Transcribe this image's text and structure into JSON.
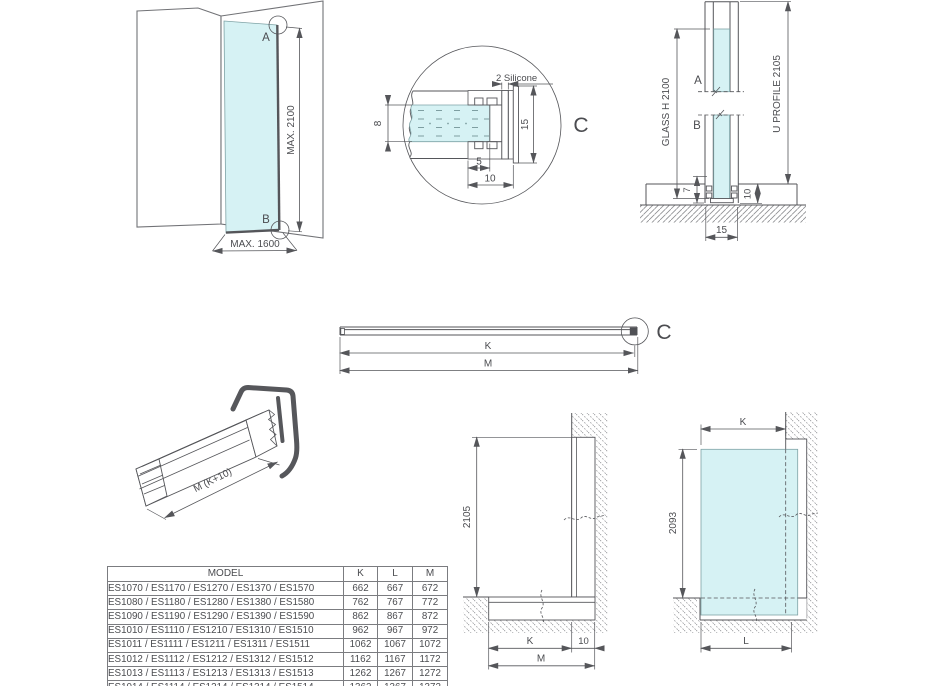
{
  "colors": {
    "line": "#55565a",
    "text": "#4b4c50",
    "glass": "#d6f2f4",
    "wall": "#717276",
    "table_border": "#7b7c80"
  },
  "corner_view": {
    "point_a": "A",
    "point_b": "B",
    "max_height": "MAX. 2100",
    "max_width": "MAX. 1600"
  },
  "detail_c": {
    "silicone_label": "2 Silicone",
    "glass_thickness": "8",
    "profile_height": "15",
    "inner_depth": "5",
    "outer_depth": "10",
    "detail_label": "C"
  },
  "vertical_section": {
    "point_a": "A",
    "point_b": "B",
    "glass_label": "GLASS H 2100",
    "profile_label": "U PROFILE 2105",
    "dim_7": "7",
    "dim_10": "10",
    "dim_15": "15"
  },
  "profile_top_view": {
    "dim_k": "K",
    "dim_m": "M",
    "detail_label": "C"
  },
  "profile_3d": {
    "length_label": "M (K+10)"
  },
  "install_section": {
    "height": "2105",
    "dim_k": "K",
    "dim_10": "10",
    "dim_m": "M"
  },
  "glass_elevation": {
    "dim_k": "K",
    "height": "2093",
    "dim_l": "L"
  },
  "model_table": {
    "headers": [
      "MODEL",
      "K",
      "L",
      "M"
    ],
    "rows": [
      {
        "model": "ES1070 / ES1170 / ES1270 / ES1370 / ES1570",
        "k": "662",
        "l": "667",
        "m": "672"
      },
      {
        "model": "ES1080 / ES1180 / ES1280 / ES1380 / ES1580",
        "k": "762",
        "l": "767",
        "m": "772"
      },
      {
        "model": "ES1090 / ES1190 / ES1290 / ES1390 / ES1590",
        "k": "862",
        "l": "867",
        "m": "872"
      },
      {
        "model": "ES1010 / ES1110 / ES1210 / ES1310 / ES1510",
        "k": "962",
        "l": "967",
        "m": "972"
      },
      {
        "model": "ES1011 / ES1111 / ES1211 / ES1311 / ES1511",
        "k": "1062",
        "l": "1067",
        "m": "1072"
      },
      {
        "model": "ES1012 / ES1112 / ES1212 / ES1312 / ES1512",
        "k": "1162",
        "l": "1167",
        "m": "1172"
      },
      {
        "model": "ES1013 / ES1113 / ES1213 / ES1313 / ES1513",
        "k": "1262",
        "l": "1267",
        "m": "1272"
      },
      {
        "model": "ES1014 / ES1114 / ES1214 / ES1314 / ES1514",
        "k": "1362",
        "l": "1367",
        "m": "1372"
      }
    ]
  }
}
